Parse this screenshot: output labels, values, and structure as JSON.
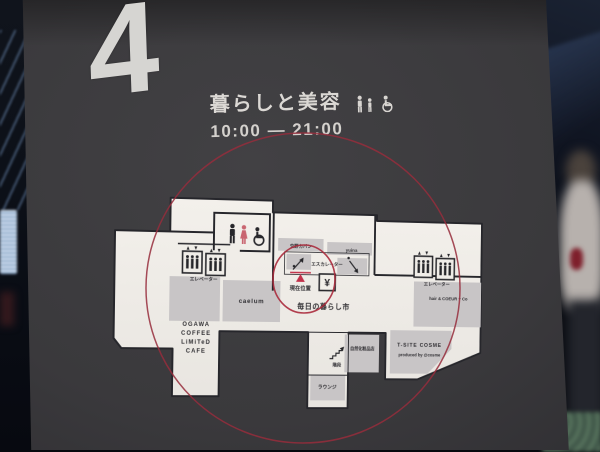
{
  "sign": {
    "floor_number": "4",
    "title": "暮らしと美容",
    "hours": "10:00 — 21:00",
    "amenity_icons": [
      "adult-icon",
      "child-icon",
      "wheelchair-icon"
    ]
  },
  "map": {
    "current_location": "現在位置",
    "atm_symbol": "¥",
    "facilities": {
      "elevator_left": "エレベーター",
      "elevator_right": "エレベーター",
      "escalator": "エスカレーター",
      "stairs": "階段",
      "lounge": "ラウンジ"
    },
    "tenants": {
      "bag_shop": "交野カバン",
      "yuina": "yuina",
      "caelum": "caelum",
      "ogawa_lines": [
        "OGAWA",
        "COFFEE",
        "LiMiTeD",
        "CAFE"
      ],
      "daily_market": "毎日の暮らし市",
      "cosmetics_shop": "自然化粧品店",
      "tsite_cosme": "T-SITE COSME",
      "tsite_cosme_sub": "produced by @cosme",
      "hair_salon": "hair & COEUR + Co"
    }
  },
  "colors": {
    "panel": "#3a393c",
    "map_floor": "#f0ede8",
    "tenant_block": "#c8c5c6",
    "accent_red": "#a84052",
    "marker_red": "#c2314a",
    "female_icon_pink": "#c96570",
    "wall_black": "#26262b",
    "sign_text": "#d9d6d2"
  }
}
